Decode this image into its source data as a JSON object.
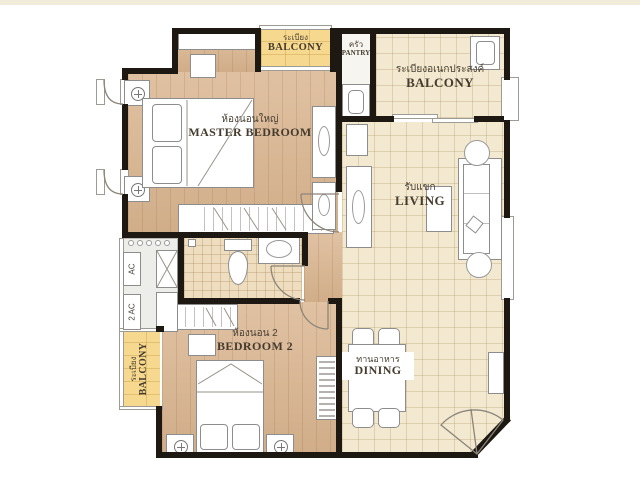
{
  "page": {
    "background": "#ffffff",
    "top_strip_color": "#f1ebd9"
  },
  "colors": {
    "wall": "#1d1812",
    "wood_floor": "#d9b48e",
    "tile_floor": "#f2e9d0",
    "bath_tile": "#eeddbe",
    "balcony_yellow": "#f6d98e",
    "ac_ledge": "#ededе9",
    "label_text": "#453b2e"
  },
  "labels": {
    "master_bedroom": {
      "thai": "ห้องนอนใหญ่",
      "english": "MASTER BEDROOM"
    },
    "bedroom_2": {
      "thai": "ห้องนอน 2",
      "english": "BEDROOM 2"
    },
    "living": {
      "thai": "รับแขก",
      "english": "LIVING"
    },
    "dining": {
      "thai": "ทานอาหาร",
      "english": "DINING"
    },
    "pantry": {
      "thai": "ครัว",
      "english": "PANTRY"
    },
    "balcony_front": {
      "thai": "ระเบียง",
      "english": "BALCONY"
    },
    "balcony_service": {
      "thai": "ระเบียงอเนกประสงค์",
      "english": "BALCONY"
    },
    "balcony_side": {
      "thai": "ระเบียง",
      "english": "BALCONY"
    },
    "ac_1": {
      "english": "AC"
    },
    "ac_2": {
      "english": "2 AC"
    }
  }
}
